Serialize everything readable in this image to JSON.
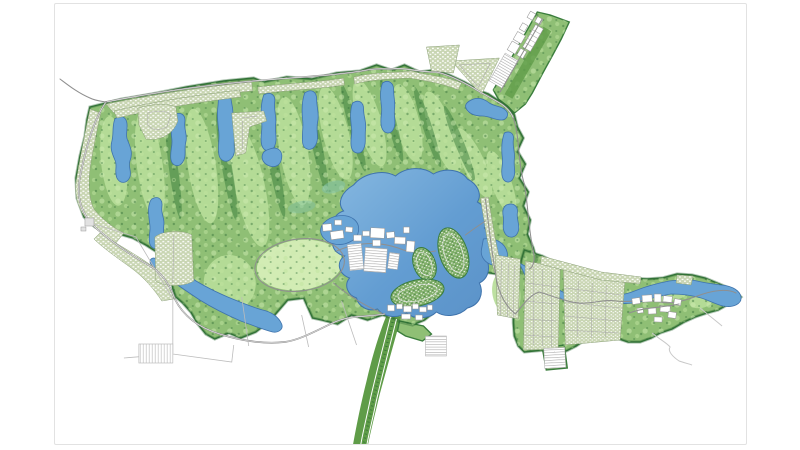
{
  "palette": {
    "background": "#ffffff",
    "frame_border": "#e2e2e2",
    "green_base": "#8fbf75",
    "green_mid": "#5f9c48",
    "green_light": "#b7dd99",
    "green_lighter": "#d2ecb4",
    "green_dark": "#3a7d3c",
    "green_darker": "#235f2c",
    "teal": "#7fc2ab",
    "water": "#68a4d6",
    "water_dark": "#3f73ac",
    "water_light": "#9cc3e6",
    "road_gray": "#8f8f8f",
    "residential_base": "#c8d5b2",
    "building_white": "#ffffff",
    "building_stroke": "#969696",
    "parcel_line": "#bcbcbc"
  },
  "map": {
    "style": "hand-drawn-watercolor-master-plan",
    "features": {
      "landmass": "golf-course-community-site",
      "water": [
        "central-lake",
        "golf-ponds-and-streams",
        "east-river-channel",
        "east-lagoon"
      ],
      "residential": [
        "north-perimeter-homes",
        "west-perimeter-homes",
        "southwest-homes",
        "lake-island-homes",
        "east-grid-homes"
      ],
      "facilities": [
        "clubhouse-complex",
        "clubhouse-parking",
        "lakeside-village",
        "east-town-center",
        "northeast-commercial-strip",
        "west-gatehouse"
      ],
      "roads": [
        "northwest-entry-road",
        "perimeter-road",
        "south-boulevard",
        "east-main-street",
        "southeast-trails"
      ],
      "open_space": [
        "central-meadow-oval",
        "southwest-future-parcels"
      ]
    }
  }
}
